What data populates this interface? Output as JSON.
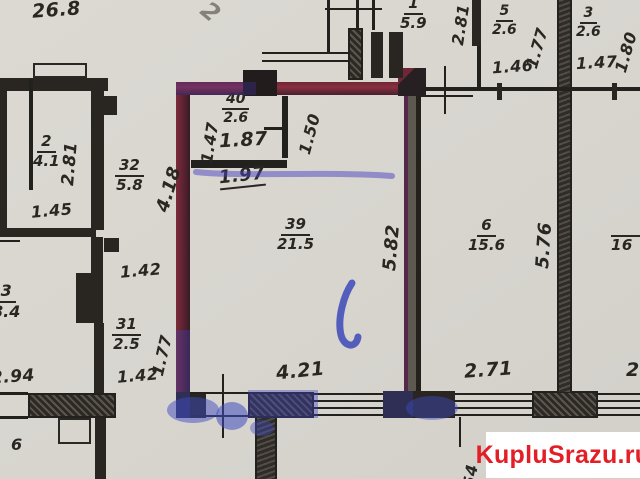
{
  "meta": {
    "description": "Photographed BTI floor plan with apartment outlined in red marker and blue pen marks"
  },
  "watermark": {
    "text": "KupluSrazu.ru",
    "color": "#e31e26"
  },
  "colors": {
    "paper": "#d8d5cf",
    "ink": "#2a2723",
    "marker_red": "#7d2a3a",
    "pen_blue": "#3b43b8",
    "watermark_red": "#e31e26"
  },
  "rooms": {
    "r1": {
      "num": "1",
      "area": "5.9"
    },
    "r2": {
      "num": "2",
      "area": "4.1"
    },
    "r3left": {
      "num": "3",
      "area": "8.4"
    },
    "r3top": {
      "num": "3",
      "area": "2.6"
    },
    "r5": {
      "num": "5",
      "area": "2.6"
    },
    "r6": {
      "num": "6",
      "area": "15.6"
    },
    "r31": {
      "num": "31",
      "area": "2.5"
    },
    "r32": {
      "num": "32",
      "area": "5.8"
    },
    "r39": {
      "num": "39",
      "area": "21.5"
    },
    "r40": {
      "num": "40",
      "area": "2.6"
    }
  },
  "dims": {
    "d268": "26.8",
    "d281_left": "2.81",
    "d145": "1.45",
    "d294": "2.94",
    "d6": "6",
    "d142_upper": "1.42",
    "d142_lower": "1.42",
    "d177_left": "1.77",
    "d418": "4.18",
    "d147_small": "1.47",
    "d150": "1.50",
    "d187": "1.87",
    "d197": "1.97",
    "d582": "5.82",
    "d421": "4.21",
    "d281_top": "2.81",
    "d177_top": "1.77",
    "d146": "1.46",
    "d180": "1.80",
    "d147_top": "1.47",
    "d576": "5.76",
    "d271": "2.71",
    "d2_cut": "2.",
    "d16_cut": "16",
    "d54_cut": "54",
    "d2_diag": "2"
  }
}
